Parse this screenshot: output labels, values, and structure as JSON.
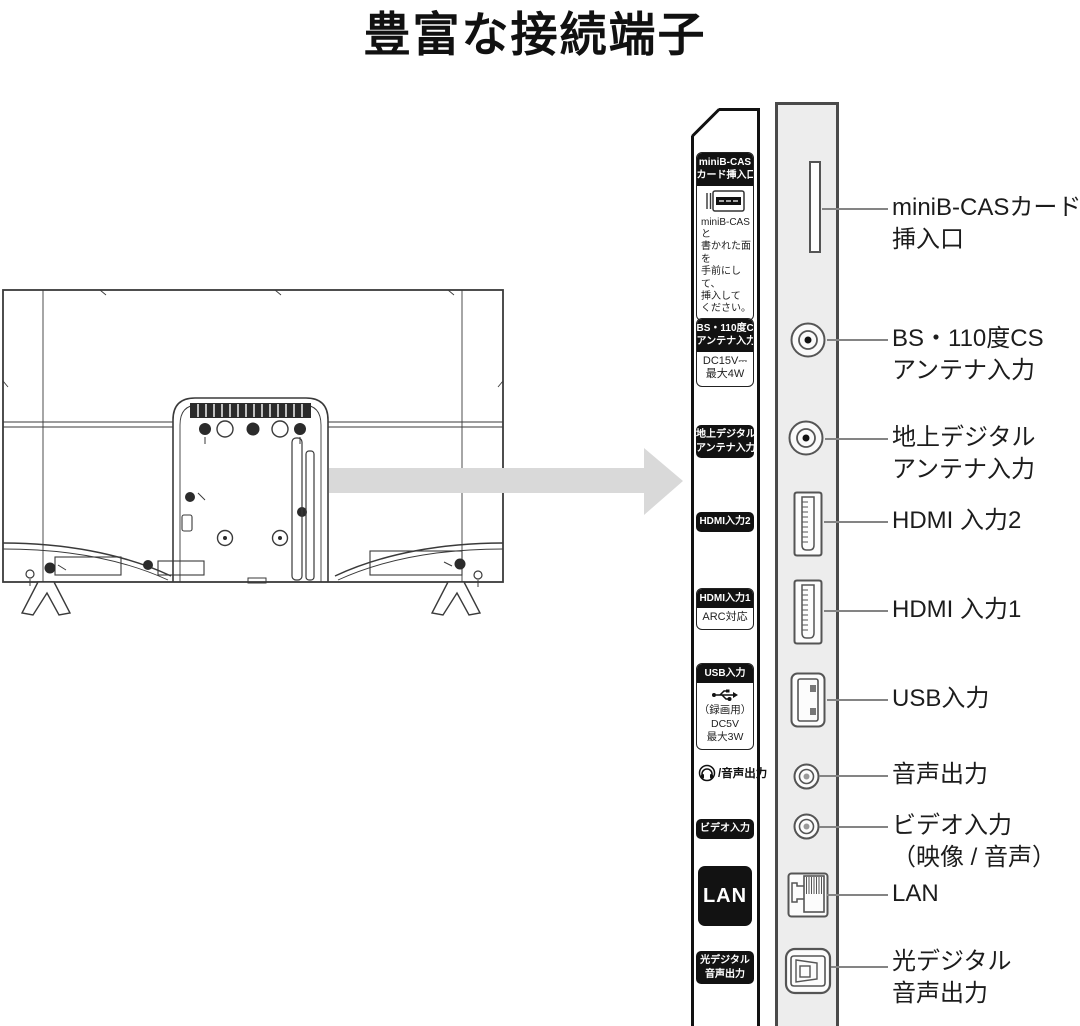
{
  "title": "豊富な接続端子",
  "colors": {
    "badge_bg": "#121212",
    "badge_text": "#ffffff",
    "panel_fill": "#ededed",
    "panel_border": "#4a4a4a",
    "arrow": "#d9d9d9",
    "strip_border": "#111111",
    "line_art": "#3a3a3a"
  },
  "strip": {
    "minibcas": {
      "badge": [
        "miniB-CAS",
        "カード挿入口"
      ],
      "note": [
        "miniB-CASと",
        "書かれた面を",
        "手前にして、",
        "挿入して",
        "ください。"
      ]
    },
    "bs": {
      "badge": [
        "BS・110度CS",
        "アンテナ入力"
      ],
      "spec": [
        "DC15V⎓",
        "最大4W"
      ]
    },
    "terrestrial": {
      "badge": [
        "地上デジタル",
        "アンテナ入力"
      ]
    },
    "hdmi2": {
      "badge": [
        "HDMI入力2"
      ]
    },
    "hdmi1": {
      "badge": [
        "HDMI入力1"
      ],
      "spec": [
        "ARC対応"
      ]
    },
    "usb": {
      "badge": [
        "USB入力"
      ],
      "spec": [
        "（録画用）",
        "DC5V",
        "最大3W"
      ]
    },
    "audio_out": {
      "label": "/音声出力"
    },
    "video_in": {
      "badge": [
        "ビデオ入力"
      ]
    },
    "lan": {
      "badge": [
        "LAN"
      ]
    },
    "optical": {
      "badge": [
        "光デジタル",
        "音声出力"
      ]
    }
  },
  "callouts": {
    "minibcas": [
      "miniB-CASカード",
      "挿入口"
    ],
    "bs": [
      "BS・110度CS",
      "アンテナ入力"
    ],
    "terrestrial": [
      "地上デジタル",
      "アンテナ入力"
    ],
    "hdmi2": [
      "HDMI 入力2"
    ],
    "hdmi1": [
      "HDMI 入力1"
    ],
    "usb": [
      "USB入力"
    ],
    "audio_out": [
      "音声出力"
    ],
    "video_in": [
      "ビデオ入力",
      "（映像 / 音声）"
    ],
    "lan": [
      "LAN"
    ],
    "optical": [
      "光デジタル",
      "音声出力"
    ]
  }
}
